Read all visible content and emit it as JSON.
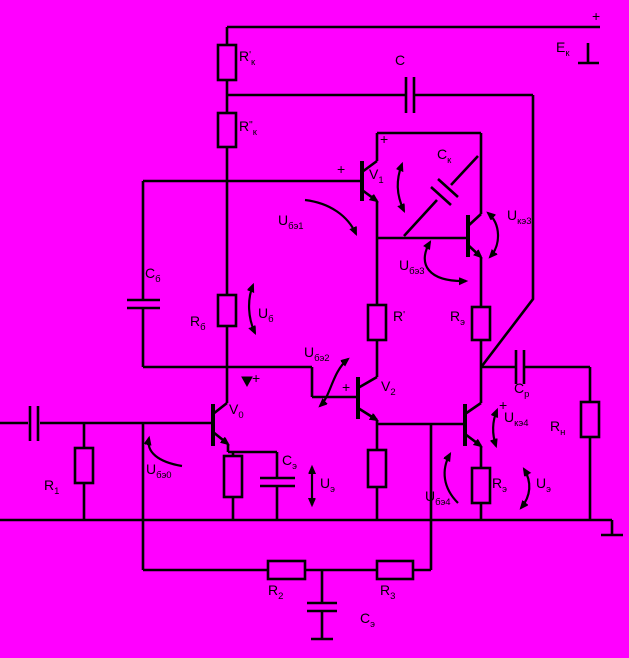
{
  "canvas": {
    "width": 629,
    "height": 658,
    "background": "#ff00ff",
    "line_color": "#000000",
    "description": "Transistor amplifier-oscillator circuit schematic, black lines on magenta background"
  },
  "labels": [
    {
      "id": "rk-prime",
      "x": 239,
      "y": 49,
      "main": "R",
      "sup": "'",
      "sub": "к"
    },
    {
      "id": "rk-dprime",
      "x": 239,
      "y": 119,
      "main": "R",
      "sup": "\"",
      "sub": "к"
    },
    {
      "id": "c-top",
      "x": 395,
      "y": 53,
      "main": "C"
    },
    {
      "id": "ek",
      "x": 556,
      "y": 40,
      "main": "E",
      "sub": "к"
    },
    {
      "id": "plus-rail",
      "x": 592,
      "y": 9,
      "main": "+"
    },
    {
      "id": "plus-v1c",
      "x": 380,
      "y": 132,
      "main": "+"
    },
    {
      "id": "v1",
      "x": 369,
      "y": 167,
      "main": "V",
      "sub": "1"
    },
    {
      "id": "ck",
      "x": 437,
      "y": 147,
      "main": "C",
      "sub": "к"
    },
    {
      "id": "plus-v1b",
      "x": 337,
      "y": 162,
      "main": "+"
    },
    {
      "id": "ube1",
      "x": 278,
      "y": 213,
      "main": "U",
      "sub": "бэ1"
    },
    {
      "id": "uke3",
      "x": 507,
      "y": 208,
      "main": "U",
      "sub": "кэ3"
    },
    {
      "id": "ube3",
      "x": 399,
      "y": 258,
      "main": "U",
      "sub": "бэ3"
    },
    {
      "id": "cb",
      "x": 145,
      "y": 266,
      "main": "C",
      "sub": "б"
    },
    {
      "id": "rb",
      "x": 190,
      "y": 314,
      "main": "R",
      "sub": "б"
    },
    {
      "id": "ub",
      "x": 258,
      "y": 306,
      "main": "U",
      "sub": "б"
    },
    {
      "id": "r-prime",
      "x": 393,
      "y": 309,
      "main": "R",
      "sup": "'"
    },
    {
      "id": "re-mid",
      "x": 450,
      "y": 309,
      "main": "R",
      "sub": "э"
    },
    {
      "id": "ube2",
      "x": 304,
      "y": 345,
      "main": "U",
      "sub": "бэ2"
    },
    {
      "id": "plus-v2",
      "x": 342,
      "y": 380,
      "main": "+"
    },
    {
      "id": "v2",
      "x": 381,
      "y": 379,
      "main": "V",
      "sub": "2"
    },
    {
      "id": "cr",
      "x": 514,
      "y": 381,
      "main": "C",
      "sub": "р"
    },
    {
      "id": "rn",
      "x": 550,
      "y": 419,
      "main": "R",
      "sub": "н"
    },
    {
      "id": "plus-v0",
      "x": 252,
      "y": 371,
      "main": "+"
    },
    {
      "id": "v0",
      "x": 229,
      "y": 402,
      "main": "V",
      "sub": "0"
    },
    {
      "id": "ube0",
      "x": 146,
      "y": 462,
      "main": "U",
      "sub": "бэ0"
    },
    {
      "id": "r1",
      "x": 44,
      "y": 478,
      "main": "R",
      "sub": "1"
    },
    {
      "id": "ce1",
      "x": 282,
      "y": 453,
      "main": "C",
      "sub": "э"
    },
    {
      "id": "ue1",
      "x": 320,
      "y": 476,
      "main": "U",
      "sub": "э"
    },
    {
      "id": "plus-v4",
      "x": 499,
      "y": 398,
      "main": "+"
    },
    {
      "id": "uke4",
      "x": 504,
      "y": 410,
      "main": "U",
      "sub": "кэ4"
    },
    {
      "id": "re4",
      "x": 492,
      "y": 476,
      "main": "R",
      "sub": "э"
    },
    {
      "id": "ue4",
      "x": 536,
      "y": 476,
      "main": "U",
      "sub": "э"
    },
    {
      "id": "ube4",
      "x": 425,
      "y": 489,
      "main": "U",
      "sub": "бэ4"
    },
    {
      "id": "r2",
      "x": 268,
      "y": 583,
      "main": "R",
      "sub": "2"
    },
    {
      "id": "r3",
      "x": 380,
      "y": 583,
      "main": "R",
      "sub": "3"
    },
    {
      "id": "ce2",
      "x": 360,
      "y": 611,
      "main": "C",
      "sub": "э"
    }
  ]
}
